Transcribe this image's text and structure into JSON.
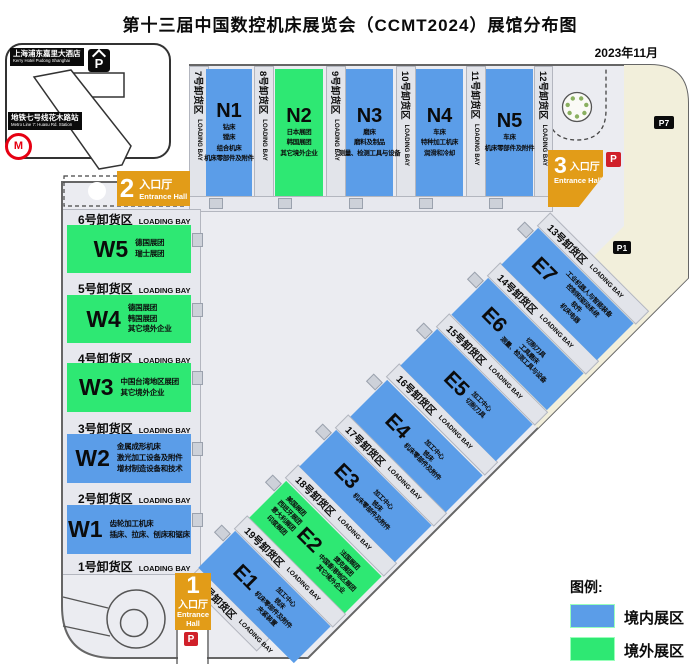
{
  "title": "第十三届中国数控机床展览会（CCMT2024）展馆分布图",
  "date": "2023年11月",
  "colors": {
    "domestic": "#5b9de8",
    "overseas": "#2ee873",
    "entrance": "#e29c18",
    "parking_red": "#d0202a",
    "parking_black": "#0b0b0b"
  },
  "landmarks": {
    "hotel_zh": "上海浦东嘉里大酒店",
    "hotel_en": "Kerry Hotel Pudong Shanghai",
    "metro_zh": "地铁七号线花木路站",
    "metro_en": "Metro Line 7: Huasu Rd. Station",
    "metro_logo": "M",
    "parking_hotel": "P",
    "parking_p7": "P7",
    "parking_p1": "P1",
    "parking_gate3": "P",
    "parking_gate1": "P"
  },
  "entrances": {
    "e1": {
      "num": "1",
      "zh": "入口厅",
      "en": "Entrance Hall"
    },
    "e2": {
      "num": "2",
      "zh": "入口厅",
      "en": "Entrance Hall"
    },
    "e3": {
      "num": "3",
      "zh": "入口厅",
      "en": "Entrance Hall"
    }
  },
  "halls": {
    "n1": {
      "name": "N1",
      "l1": "钻床",
      "l2": "镗床",
      "l3": "组合机床",
      "l4": "机床零部件及附件"
    },
    "n2": {
      "name": "N2",
      "l1": "日本展团",
      "l2": "韩国展团",
      "l3": "其它境外企业"
    },
    "n3": {
      "name": "N3",
      "l1": "磨床",
      "l2": "磨料及制品",
      "l3": "测量、检测工具与设备"
    },
    "n4": {
      "name": "N4",
      "l1": "车床",
      "l2": "特种加工机床",
      "l3": "润滑和冷却"
    },
    "n5": {
      "name": "N5",
      "l1": "车床",
      "l2": "机床零部件及附件"
    },
    "w5": {
      "name": "W5",
      "l1": "德国展团",
      "l2": "瑞士展团"
    },
    "w4": {
      "name": "W4",
      "l1": "德国展团",
      "l2": "韩国展团",
      "l3": "其它境外企业"
    },
    "w3": {
      "name": "W3",
      "l1": "中国台湾地区展团",
      "l2": "其它境外企业"
    },
    "w2": {
      "name": "W2",
      "l1": "金属成形机床",
      "l2": "激光加工设备及附件",
      "l3": "增材制造设备和技术"
    },
    "w1": {
      "name": "W1",
      "l1": "齿轮加工机床",
      "l2": "插床、拉床、刨床和锯床"
    },
    "e7": {
      "name": "E7",
      "l1": "工业机器人与智能装备",
      "l2": "控制和驱动系统",
      "l3": "软件",
      "l4": "机床电器"
    },
    "e6": {
      "name": "E6",
      "l1": "切削刀具",
      "l2": "工具磨床",
      "l3": "测量、检测工具与设备"
    },
    "e5": {
      "name": "E5",
      "l1": "加工中心",
      "l2": "切削刀具"
    },
    "e4": {
      "name": "E4",
      "l1": "加工中心",
      "l2": "铣床",
      "l3": "机床零部件及附件"
    },
    "e3": {
      "name": "E3",
      "l1": "加工中心",
      "l2": "铣床",
      "l3": "机床零部件及附件"
    },
    "e2": {
      "name": "E2",
      "left1": "美国展团",
      "left2": "西班牙展团",
      "left3": "意大利展团",
      "left4": "印度展团",
      "r1": "法国展团",
      "r2": "捷克展团",
      "r3": "中国香港地区展团",
      "r4": "其它境外企业"
    },
    "e1": {
      "name": "E1",
      "l1": "加工中心",
      "l2": "铣床",
      "l3": "机床零部件及附件",
      "l4": "夹紧装置"
    }
  },
  "bays": {
    "b1": {
      "zh": "1号卸货区",
      "en": "LOADING BAY"
    },
    "b2": {
      "zh": "2号卸货区",
      "en": "LOADING BAY"
    },
    "b3": {
      "zh": "3号卸货区",
      "en": "LOADING BAY"
    },
    "b4": {
      "zh": "4号卸货区",
      "en": "LOADING BAY"
    },
    "b5": {
      "zh": "5号卸货区",
      "en": "LOADING BAY"
    },
    "b6": {
      "zh": "6号卸货区",
      "en": "LOADING BAY"
    },
    "b7": {
      "zh": "7号卸货区",
      "en": "LOADING BAY"
    },
    "b8": {
      "zh": "8号卸货区",
      "en": "LOADING BAY"
    },
    "b9": {
      "zh": "9号卸货区",
      "en": "LOADING BAY"
    },
    "b10": {
      "zh": "10号卸货区",
      "en": "LOADING BAY"
    },
    "b11": {
      "zh": "11号卸货区",
      "en": "LOADING BAY"
    },
    "b12": {
      "zh": "12号卸货区",
      "en": "LOADING BAY"
    },
    "b13": {
      "zh": "13号卸货区",
      "en": "LOADING BAY"
    },
    "b14": {
      "zh": "14号卸货区",
      "en": "LOADING BAY"
    },
    "b15": {
      "zh": "15号卸货区",
      "en": "LOADING BAY"
    },
    "b16": {
      "zh": "16号卸货区",
      "en": "LOADING BAY"
    },
    "b17": {
      "zh": "17号卸货区",
      "en": "LOADING BAY"
    },
    "b18": {
      "zh": "18号卸货区",
      "en": "LOADING BAY"
    },
    "b19": {
      "zh": "19号卸货区",
      "en": "LOADING BAY"
    },
    "b20": {
      "zh": "20号卸货区",
      "en": "LOADING BAY"
    }
  },
  "legend": {
    "heading": "图例:",
    "items": [
      {
        "label": "境内展区",
        "color": "#5b9de8"
      },
      {
        "label": "境外展区",
        "color": "#2ee873"
      }
    ]
  }
}
